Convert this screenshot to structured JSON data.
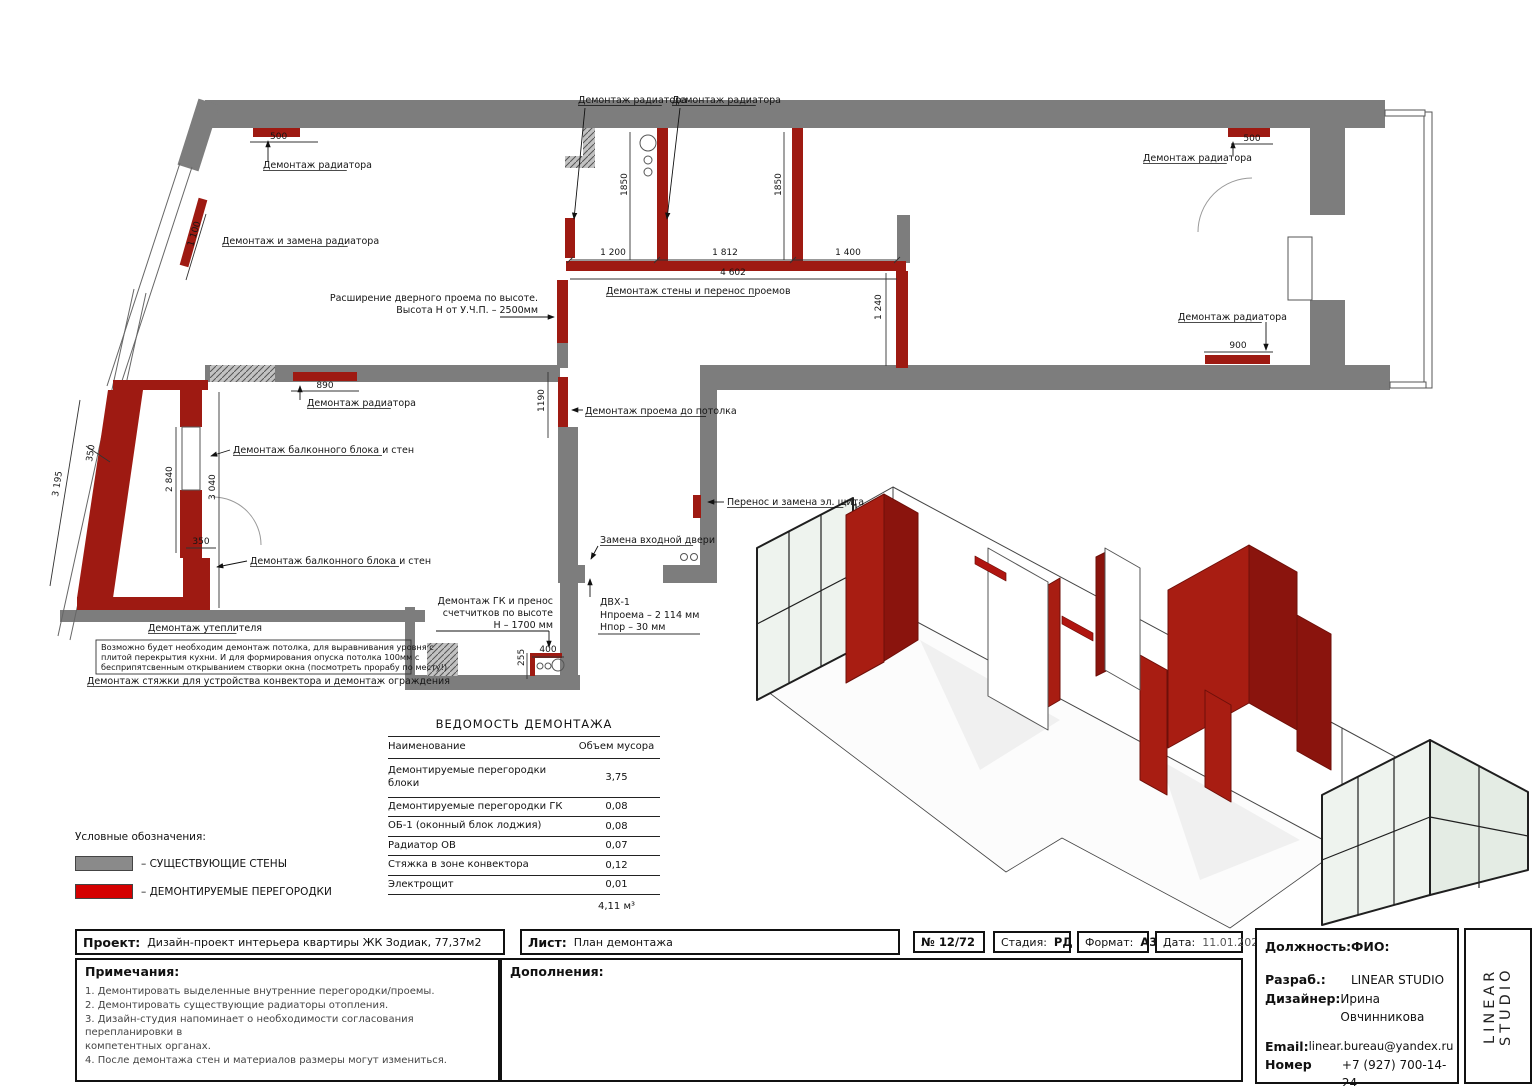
{
  "colors": {
    "wall_gray": "#7d7d7d",
    "demolition_red": "#9e1a12",
    "legend_red": "#d40000",
    "axo_red": "#a81d12"
  },
  "plan": {
    "texts": [
      {
        "n": "demontazh-radiatora-topleft",
        "t": "Демонтаж радиатора",
        "x": 263,
        "y": 168,
        "u": 1
      },
      {
        "n": "dim-500-left",
        "t": "500",
        "x": 270,
        "y": 139,
        "fs": 9
      },
      {
        "n": "dim-1100",
        "t": "1 100",
        "x": 193,
        "y": 247,
        "r": -73,
        "fs": 9
      },
      {
        "n": "demontazh-zamena-radiatora",
        "t": "Демонтаж и замена радиатора",
        "x": 222,
        "y": 244,
        "u": 1
      },
      {
        "n": "demontazh-radiatora-top1",
        "t": "Демонтаж радиатора",
        "x": 578,
        "y": 103,
        "u": 1
      },
      {
        "n": "demontazh-radiatora-top2",
        "t": "Демонтаж радиатора",
        "x": 672,
        "y": 103,
        "u": 1
      },
      {
        "n": "dim-1850-a",
        "t": "1850",
        "x": 627,
        "y": 196,
        "r": -90,
        "fs": 9
      },
      {
        "n": "dim-1850-b",
        "t": "1850",
        "x": 781,
        "y": 196,
        "r": -90,
        "fs": 9
      },
      {
        "n": "dim-1200",
        "t": "1 200",
        "x": 613,
        "y": 255,
        "a": "m",
        "fs": 9
      },
      {
        "n": "dim-1812",
        "t": "1 812",
        "x": 725,
        "y": 255,
        "a": "m",
        "fs": 9
      },
      {
        "n": "dim-1400",
        "t": "1 400",
        "x": 848,
        "y": 255,
        "a": "m",
        "fs": 9
      },
      {
        "n": "dim-4602",
        "t": "4 602",
        "x": 733,
        "y": 275,
        "a": "m",
        "fs": 9
      },
      {
        "n": "demontazh-steny-perenos",
        "t": "Демонтаж стены и перенос проемов",
        "x": 606,
        "y": 294,
        "u": 1
      },
      {
        "n": "dim-1240",
        "t": "1 240",
        "x": 881,
        "y": 320,
        "r": -90,
        "fs": 9
      },
      {
        "n": "rasshirenie-line1",
        "t": "Расширение дверного проема по высоте.",
        "x": 538,
        "y": 301,
        "a": "e"
      },
      {
        "n": "rasshirenie-line2",
        "t": "Высота Н от У.Ч.П. – 2500мм",
        "x": 538,
        "y": 313,
        "a": "e"
      },
      {
        "n": "dim-1190",
        "t": "1190",
        "x": 544,
        "y": 412,
        "r": -90,
        "fs": 9
      },
      {
        "n": "demontazh-proema",
        "t": "Демонтаж проема до потолка",
        "x": 585,
        "y": 414,
        "u": 1
      },
      {
        "n": "dim-890",
        "t": "890",
        "x": 325,
        "y": 388,
        "a": "m",
        "fs": 9
      },
      {
        "n": "demontazh-radiatora-kitchen",
        "t": "Демонтаж радиатора",
        "x": 307,
        "y": 406,
        "u": 1
      },
      {
        "n": "demontazh-balkon-1",
        "t": "Демонтаж балконного блока и стен",
        "x": 233,
        "y": 453,
        "u": 1
      },
      {
        "n": "dim-2840",
        "t": "2 840",
        "x": 172,
        "y": 492,
        "r": -90,
        "fs": 9
      },
      {
        "n": "dim-3040",
        "t": "3 040",
        "x": 215,
        "y": 500,
        "r": -90,
        "fs": 9
      },
      {
        "n": "dim-3195",
        "t": "3 195",
        "x": 58,
        "y": 497,
        "r": -81,
        "fs": 9
      },
      {
        "n": "dim-350-diag",
        "t": "350",
        "x": 92,
        "y": 462,
        "r": -81,
        "fs": 9
      },
      {
        "n": "dim-350-h",
        "t": "350",
        "x": 201,
        "y": 544,
        "a": "m",
        "fs": 9
      },
      {
        "n": "demontazh-balkon-2",
        "t": "Демонтаж балконного блока и стен",
        "x": 250,
        "y": 564,
        "u": 1
      },
      {
        "n": "demontazh-uteplitelya",
        "t": "Демонтаж утеплителя",
        "x": 148,
        "y": 631,
        "u": 1
      },
      {
        "n": "note-ceiling-1",
        "t": "Возможно будет необходим демонтаж потолка, для выравнивания уровня с",
        "x": 101,
        "y": 650,
        "fs": 8.2
      },
      {
        "n": "note-ceiling-2",
        "t": "плитой перекрытия кухни. И для формирования опуска потолка 100мм с",
        "x": 101,
        "y": 660,
        "fs": 8.2
      },
      {
        "n": "note-ceiling-3",
        "t": "бесприпятсвенным открыванием створки окна (посмотреть прорабу по месту!)",
        "x": 101,
        "y": 670,
        "fs": 8.2
      },
      {
        "n": "demontazh-styazhki",
        "t": "Демонтаж стяжки для устройства конвектора и демонтаж ограждения",
        "x": 87,
        "y": 684,
        "u": 1
      },
      {
        "n": "gk-line1",
        "t": "Демонтаж ГК и пренос",
        "x": 553,
        "y": 604,
        "a": "e"
      },
      {
        "n": "gk-line2",
        "t": "счетчитков по высоте",
        "x": 553,
        "y": 616,
        "a": "e"
      },
      {
        "n": "gk-line3",
        "t": "Н – 1700 мм",
        "x": 553,
        "y": 628,
        "a": "e"
      },
      {
        "n": "dim-400",
        "t": "400",
        "x": 548,
        "y": 652,
        "a": "m",
        "fs": 9
      },
      {
        "n": "dim-255",
        "t": "255",
        "x": 524,
        "y": 666,
        "r": -90,
        "fs": 9
      },
      {
        "n": "zamena-dveri",
        "t": "Замена входной двери",
        "x": 600,
        "y": 543,
        "u": 1
      },
      {
        "n": "dvx-1",
        "t": "ДВХ-1",
        "x": 600,
        "y": 605
      },
      {
        "n": "dvx-2",
        "t": "Нпроема – 2 114 мм",
        "x": 600,
        "y": 618
      },
      {
        "n": "dvx-3",
        "t": "Нпор – 30 мм",
        "x": 600,
        "y": 630
      },
      {
        "n": "perenos-shchita",
        "t": "Перенос и замена эл. щита",
        "x": 727,
        "y": 505,
        "u": 1
      },
      {
        "n": "demontazh-radiatora-right1",
        "t": "Демонтаж радиатора",
        "x": 1143,
        "y": 161,
        "u": 1
      },
      {
        "n": "dim-500-right",
        "t": "500",
        "x": 1252,
        "y": 141,
        "a": "m",
        "fs": 9
      },
      {
        "n": "demontazh-radiatora-right2",
        "t": "Демонтаж радиатора",
        "x": 1178,
        "y": 320,
        "u": 1
      },
      {
        "n": "dim-900-right",
        "t": "900",
        "x": 1238,
        "y": 348,
        "a": "m",
        "fs": 9
      }
    ]
  },
  "table": {
    "title": "ВЕДОМОСТЬ ДЕМОНТАЖА",
    "col_name": "Наименование",
    "col_value": "Объем мусора",
    "rows": [
      {
        "name": "Демонтируемые перегородки блоки",
        "value": "3,75"
      },
      {
        "name": "Демонтируемые перегородки ГК",
        "value": "0,08"
      },
      {
        "name": "ОБ-1 (оконный блок лоджия)",
        "value": "0,08"
      },
      {
        "name": "Радиатор ОВ",
        "value": "0,07"
      },
      {
        "name": "Стяжка в зоне конвектора",
        "value": "0,12"
      },
      {
        "name": "Электрощит",
        "value": "0,01"
      }
    ],
    "total": "4,11 м³"
  },
  "legend": {
    "title": "Условные обозначения:",
    "existing": "– СУЩЕСТВУЮЩИЕ СТЕНЫ",
    "demolished": "– ДЕМОНТИРУЕМЫЕ ПЕРЕГОРОДКИ"
  },
  "stamp": {
    "project_label": "Проект:",
    "project_value": "Дизайн-проект интерьера квартиры ЖК Зодиак, 77,37м2",
    "sheet_label": "Лист:",
    "sheet_value": "План демонтажа",
    "number": "№ 12/72",
    "stage_label": "Стадия:",
    "stage_value": "РД",
    "format_label": "Формат:",
    "format_value": "А3",
    "date_label": "Дата:",
    "date_value": "11.01.2026",
    "notes_label": "Примечания:",
    "notes": [
      "1. Демонтировать выделенные внутренние перегородки/проемы.",
      "2. Демонтировать существующие радиаторы отопления.",
      "3. Дизайн-студия напоминает о необходимости согласования перепланировки в",
      "компетентных органах.",
      "4. После демонтажа стен и материалов размеры могут измениться."
    ],
    "additions_label": "Дополнения:",
    "role_label": "Должность:",
    "fio_label": "ФИО:",
    "dev_label": "Разраб.:",
    "dev_value": "LINEAR STUDIO",
    "designer_label": "Дизайнер:",
    "designer_value": "Ирина Овчинникова",
    "email_label": "Email:",
    "email_value": "linear.bureau@yandex.ru",
    "phone_label1": "Номер",
    "phone_label2": "телефона:",
    "phone_value": "+7 (927) 700-14-24",
    "studio_vertical": "LINEAR STUDIO"
  }
}
